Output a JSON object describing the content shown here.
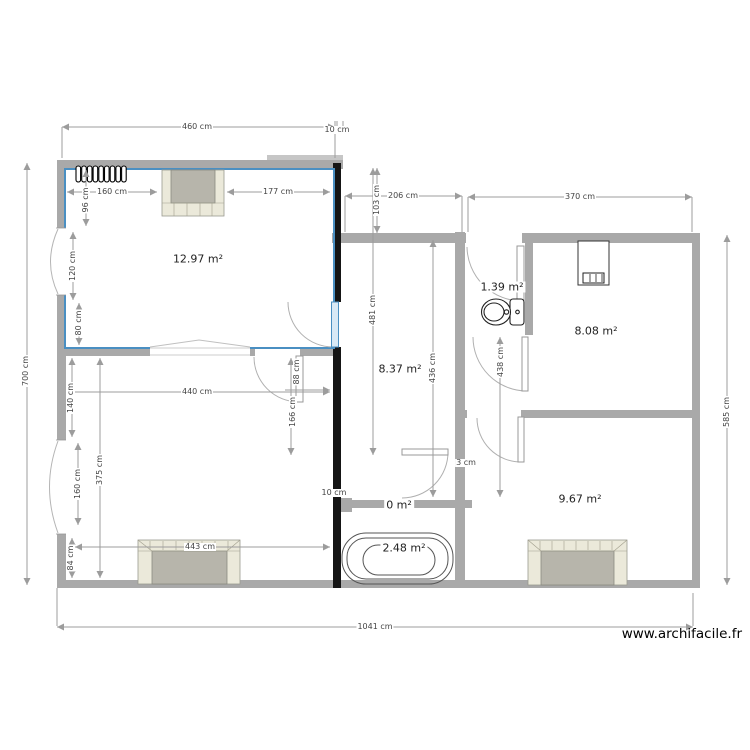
{
  "watermark": "www.archifacile.fr",
  "rooms": [
    {
      "name": "top-left-bedroom",
      "area_label": "12.97 m²",
      "x": 198,
      "y": 259
    },
    {
      "name": "hallway",
      "area_label": "8.37 m²",
      "x": 400,
      "y": 369
    },
    {
      "name": "wc",
      "area_label": "1.39 m²",
      "x": 502,
      "y": 287
    },
    {
      "name": "top-right-room",
      "area_label": "8.08 m²",
      "x": 596,
      "y": 331
    },
    {
      "name": "bottom-right-room",
      "area_label": "9.67 m²",
      "x": 580,
      "y": 499
    },
    {
      "name": "corridor",
      "area_label": "0 m²",
      "x": 399,
      "y": 505
    },
    {
      "name": "bathroom",
      "area_label": "2.48 m²",
      "x": 404,
      "y": 548
    }
  ],
  "dim_labels": {
    "horizontal": [
      {
        "text": "460 cm",
        "x": 197,
        "y": 127
      },
      {
        "text": "10 cm",
        "x": 337,
        "y": 130
      },
      {
        "text": "206 cm",
        "x": 403,
        "y": 196
      },
      {
        "text": "370 cm",
        "x": 580,
        "y": 197
      },
      {
        "text": "160 cm",
        "x": 112,
        "y": 192
      },
      {
        "text": "177 cm",
        "x": 278,
        "y": 192
      },
      {
        "text": "440 cm",
        "x": 197,
        "y": 392
      },
      {
        "text": "443 cm",
        "x": 200,
        "y": 547
      },
      {
        "text": "1041 cm",
        "x": 375,
        "y": 627
      },
      {
        "text": "3 cm",
        "x": 466,
        "y": 463
      },
      {
        "text": "10 cm",
        "x": 334,
        "y": 493
      }
    ],
    "vertical": [
      {
        "text": "700 cm",
        "x": 26,
        "y": 371
      },
      {
        "text": "96 cm",
        "x": 86,
        "y": 200
      },
      {
        "text": "120 cm",
        "x": 73,
        "y": 266
      },
      {
        "text": "80 cm",
        "x": 79,
        "y": 323
      },
      {
        "text": "140 cm",
        "x": 71,
        "y": 398
      },
      {
        "text": "375 cm",
        "x": 100,
        "y": 470
      },
      {
        "text": "160 cm",
        "x": 78,
        "y": 484
      },
      {
        "text": "84 cm",
        "x": 71,
        "y": 558
      },
      {
        "text": "88 cm",
        "x": 297,
        "y": 372
      },
      {
        "text": "166 cm",
        "x": 293,
        "y": 412
      },
      {
        "text": "103 cm",
        "x": 377,
        "y": 200
      },
      {
        "text": "481 cm",
        "x": 373,
        "y": 310
      },
      {
        "text": "436 cm",
        "x": 433,
        "y": 368
      },
      {
        "text": "438 cm",
        "x": 501,
        "y": 362
      },
      {
        "text": "585 cm",
        "x": 727,
        "y": 412
      }
    ]
  },
  "fixtures": [
    "radiator",
    "fireplace-top",
    "fireplace-bottom-left",
    "fireplace-bottom-right",
    "toilet",
    "bathtub",
    "electrical-panel"
  ],
  "colors": {
    "selection_blue": "#4a8fc2",
    "wall_gray": "#a9a9a9",
    "wall_light": "#c6c6c6",
    "wall_black": "#151515",
    "dim_gray": "#9c9c9c",
    "fireplace_beige": "#ebe9da",
    "firebox_gray": "#b7b5ab"
  }
}
